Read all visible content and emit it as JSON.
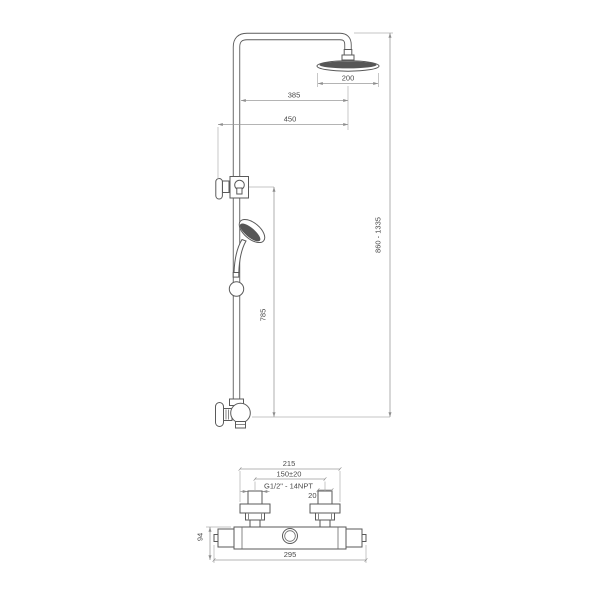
{
  "colors": {
    "background": "#ffffff",
    "object_line": "#5a5a5a",
    "dimension_line": "#9b9b9b",
    "label_text": "#4a4a4a",
    "shower_face_fill": "#565656"
  },
  "drawing": {
    "subject": "shower-column-with-thermostat-technical-drawing",
    "views": {
      "column": {
        "dims": {
          "head_diameter": "200",
          "arm_projection": "385",
          "total_projection": "450",
          "height_range": "860 - 1335",
          "rail_height": "785"
        }
      },
      "mixer": {
        "dims": {
          "escutcheon_span": "215",
          "inlet_spacing": "150±20",
          "thread_spec": "G1/2\" - 14NPT",
          "inlet_size": "20",
          "body_height": "94",
          "overall_width": "295"
        }
      }
    }
  }
}
